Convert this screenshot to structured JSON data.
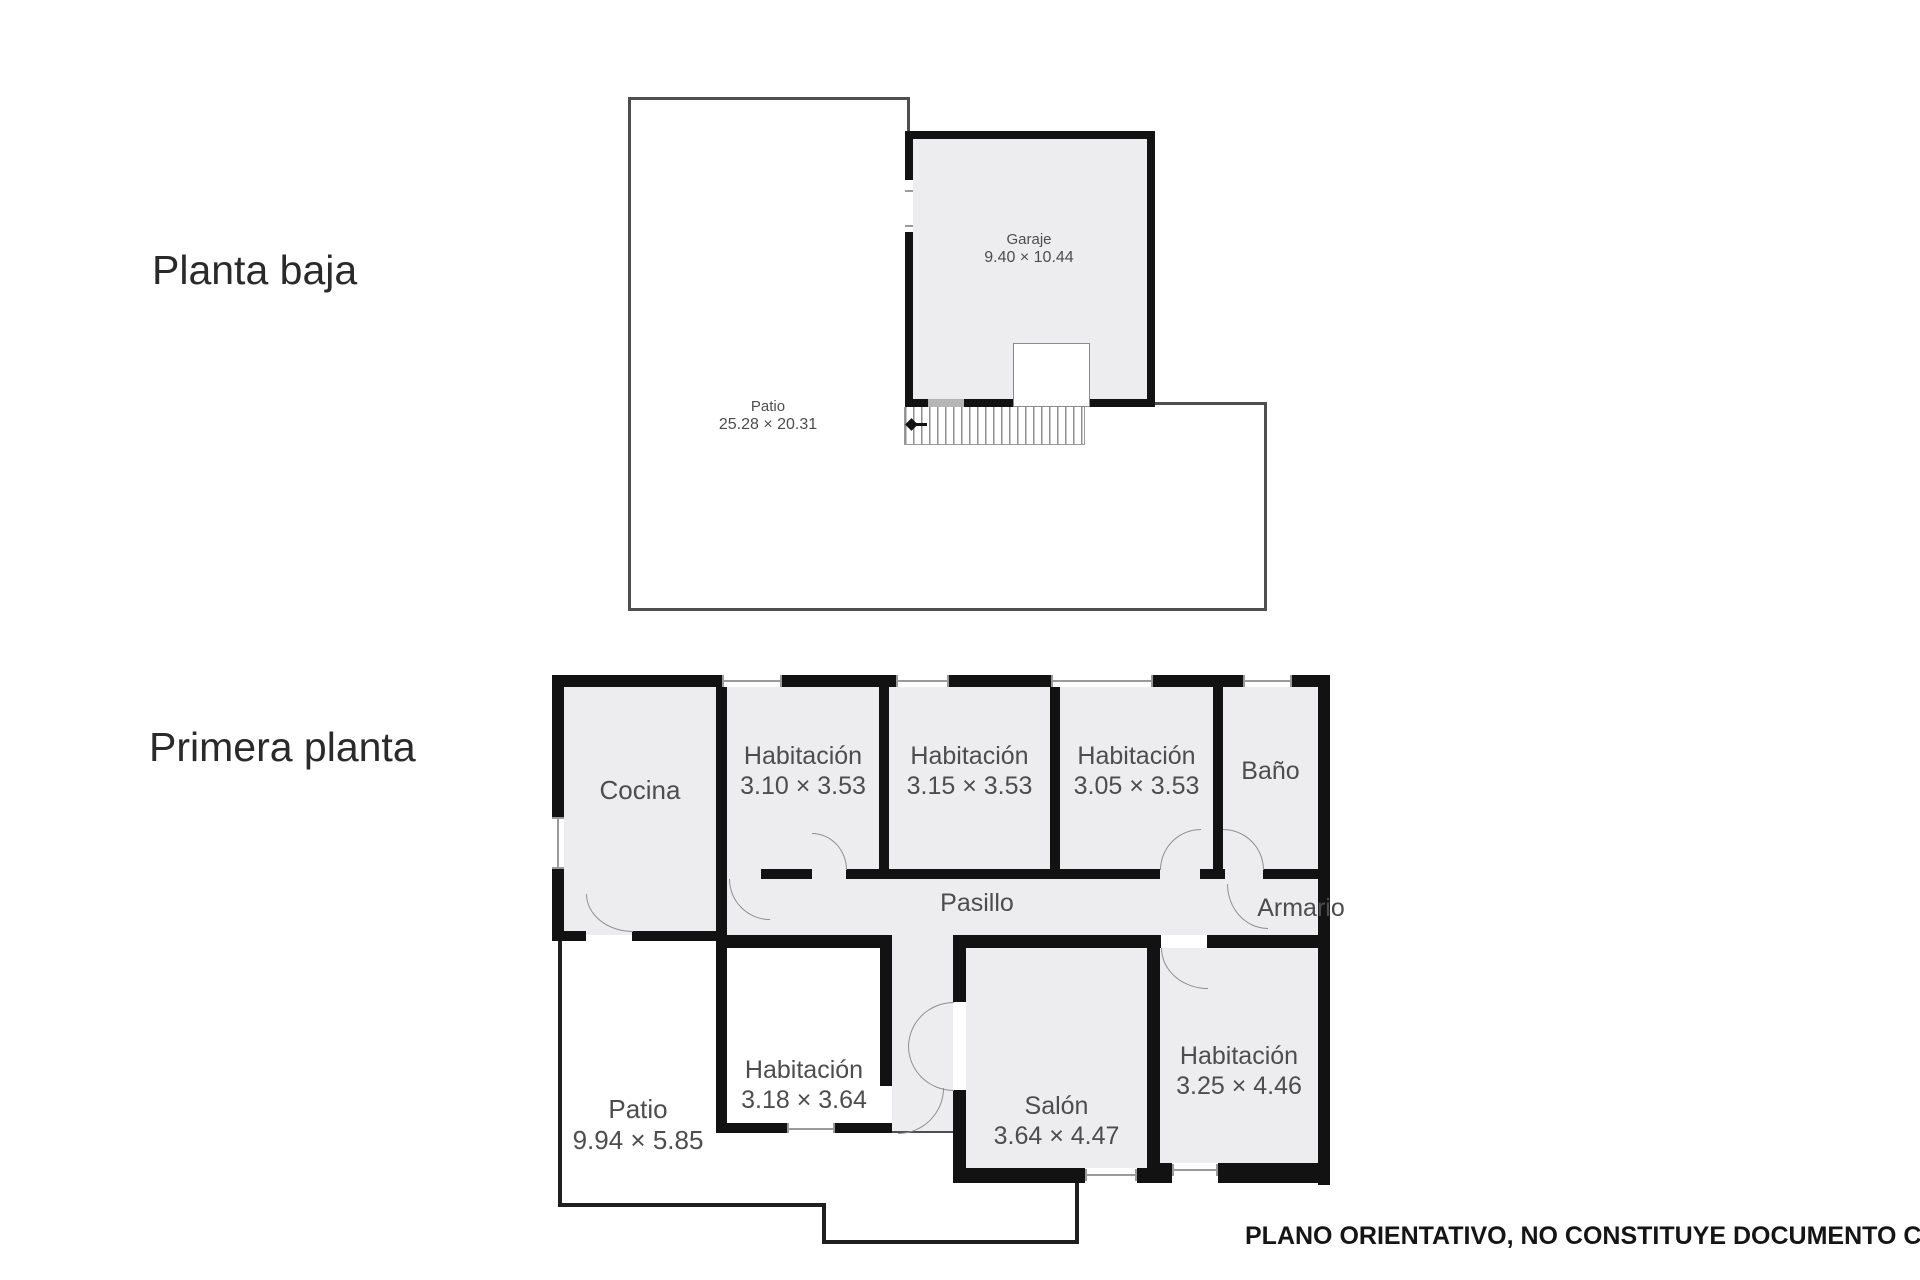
{
  "colors": {
    "wall": "#121212",
    "room_fill": "#ededef",
    "outline_thin": "#4f4f4f",
    "outline_patio": "#1f1f1f",
    "label": "#4d4d4d",
    "title": "#2a2a2a"
  },
  "ground_floor": {
    "title": "Planta baja",
    "garaje": {
      "name": "Garaje",
      "dims": "9.40 × 10.44"
    },
    "patio": {
      "name": "Patio",
      "dims": "25.28 × 20.31"
    }
  },
  "first_floor": {
    "title": "Primera planta",
    "cocina": {
      "name": "Cocina"
    },
    "hab1": {
      "name": "Habitación",
      "dims": "3.10 × 3.53"
    },
    "hab2": {
      "name": "Habitación",
      "dims": "3.15 × 3.53"
    },
    "hab3": {
      "name": "Habitación",
      "dims": "3.05 × 3.53"
    },
    "bano": {
      "name": "Baño"
    },
    "pasillo": {
      "name": "Pasillo"
    },
    "armario": {
      "name": "Armario"
    },
    "hab4": {
      "name": "Habitación",
      "dims": "3.18 × 3.64"
    },
    "salon": {
      "name": "Salón",
      "dims": "3.64 × 4.47"
    },
    "hab5": {
      "name": "Habitación",
      "dims": "3.25 × 4.46"
    },
    "patio": {
      "name": "Patio",
      "dims": "9.94 × 5.85"
    }
  },
  "footer": {
    "disclaimer": "PLANO ORIENTATIVO, NO CONSTITUYE DOCUMENTO CONTRAC"
  }
}
